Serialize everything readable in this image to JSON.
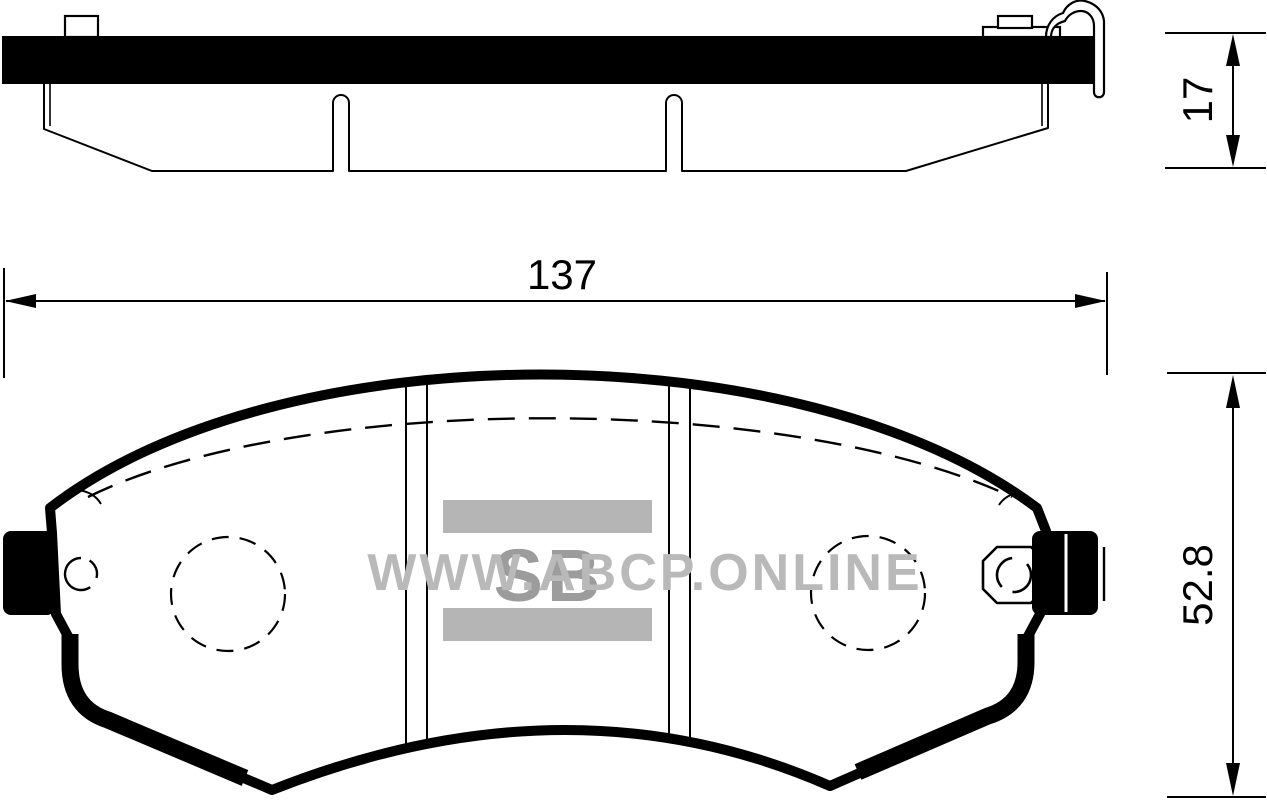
{
  "drawing": {
    "subject": "brake-pad-technical-drawing",
    "dimensions": {
      "width": "137",
      "thickness": "17",
      "height": "52.8"
    },
    "watermark": {
      "text": "WWW.ABCP.ONLINE",
      "logo": "SB"
    },
    "colors": {
      "line": "#000000",
      "background": "#ffffff",
      "watermark_text": "#b9b9b9",
      "watermark_bar": "#b5b5b5",
      "watermark_logo": "#9c9c9c"
    }
  }
}
